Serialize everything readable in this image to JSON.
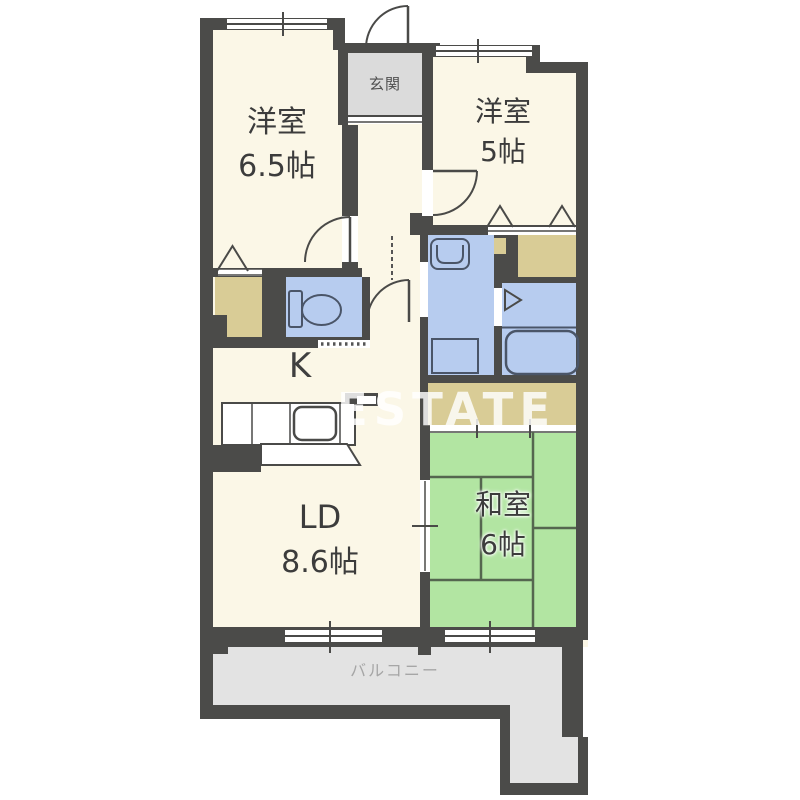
{
  "watermark": "ESTATE",
  "rooms": {
    "western1": {
      "name": "洋室",
      "size": "6.5帖"
    },
    "western2": {
      "name": "洋室",
      "size": "5帖"
    },
    "entrance": {
      "name": "玄関"
    },
    "kitchen": {
      "name": "K"
    },
    "living_dining": {
      "name": "LD",
      "size": "8.6帖"
    },
    "japanese": {
      "name": "和室",
      "size": "6帖"
    },
    "balcony": {
      "name": "バルコニー"
    }
  },
  "colors": {
    "wall": "#4B4B49",
    "floor": "#FBF7E7",
    "wet_area": "#B7CCEF",
    "tatami": "#B2E5A2",
    "closet": "#D9CC96",
    "entrance_floor": "#DBDBDB",
    "balcony_floor": "#E3E3E3"
  },
  "fixtures": [
    "toilet",
    "washbasin",
    "washing-machine",
    "bathtub",
    "kitchen-sink",
    "stove"
  ]
}
